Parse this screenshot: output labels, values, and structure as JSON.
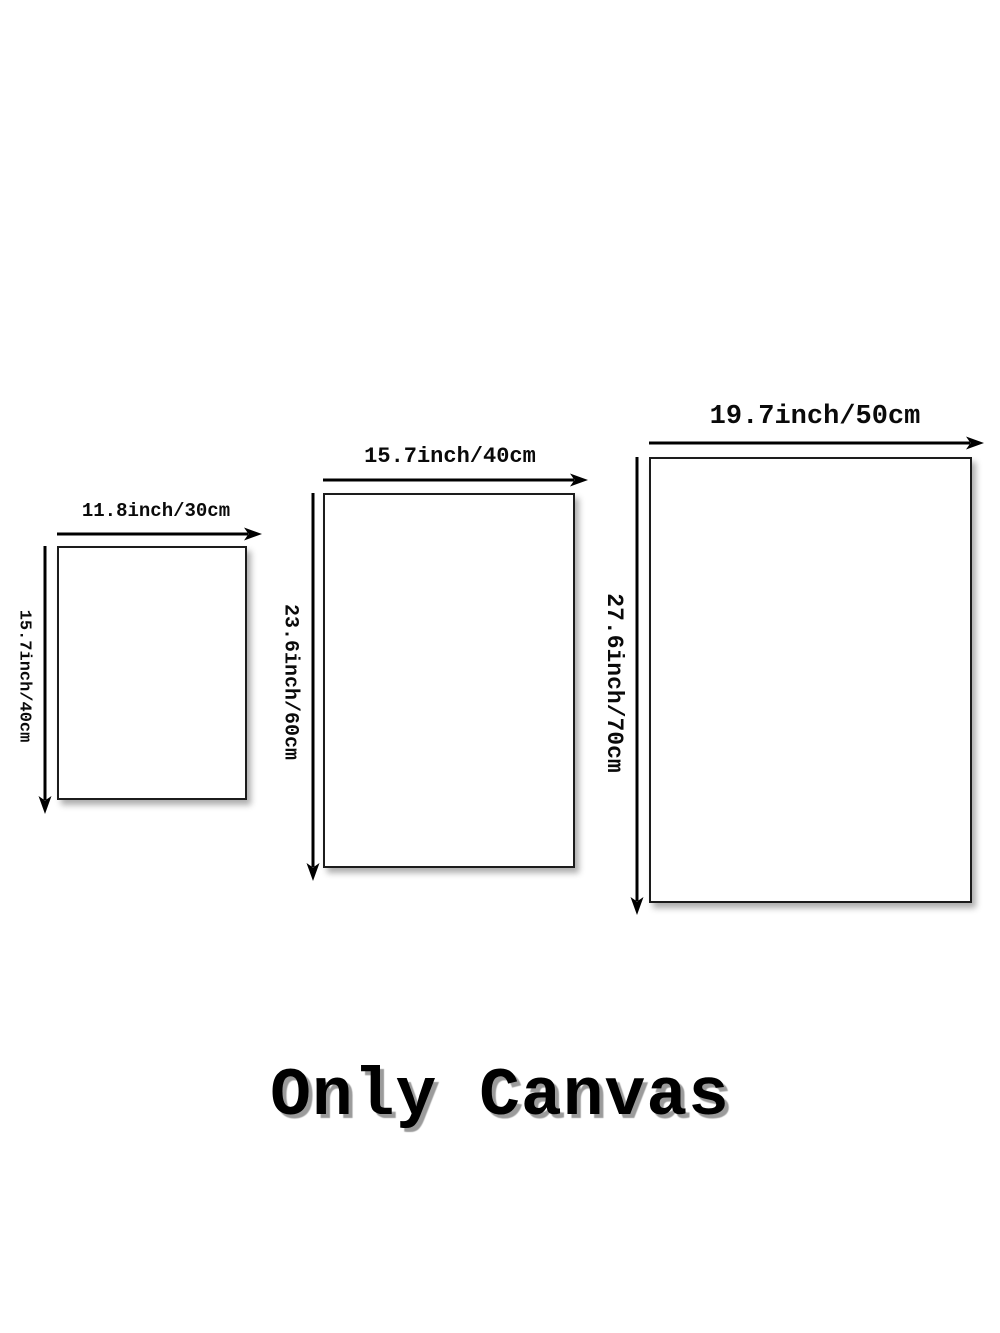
{
  "sizes": [
    {
      "id": "small",
      "width_label": "11.8inch/30cm",
      "height_label": "15.7inch/40cm"
    },
    {
      "id": "medium",
      "width_label": "15.7inch/40cm",
      "height_label": "23.6inch/60cm"
    },
    {
      "id": "large",
      "width_label": "19.7inch/50cm",
      "height_label": "27.6inch/70cm"
    }
  ],
  "footer": {
    "text": "Only Canvas"
  },
  "colors": {
    "background": "#ffffff",
    "line": "#000000",
    "text": "#000000",
    "caption_shadow": "#9b9b9b"
  }
}
